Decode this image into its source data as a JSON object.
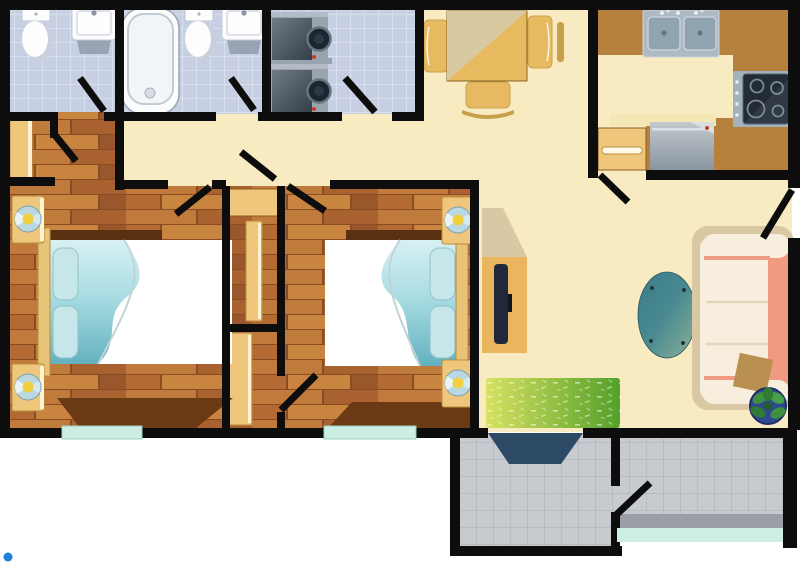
{
  "scene": {
    "type": "apartment-floor-plan",
    "style": "top-down illustrated floor plan, no text labels",
    "canvas": {
      "width": 800,
      "height": 564
    }
  },
  "colors": {
    "wall": "#0d0d0d",
    "cream": "#f8ebc2",
    "counter_dark": "#b5813d",
    "furniture_tan": "#eec77c",
    "window_teal": "#cdeee2",
    "bath_tile": "#c7cfe2",
    "gray_tile": "#c7cacf",
    "wood_base": "#b46b33",
    "bed_teal": "#8ccbd4",
    "pillow": "#c6e6ea",
    "sheet_white": "#ffffff",
    "sofa_cream": "#f7eedd",
    "sofa_salmon": "#f09a82",
    "shadow_beige": "#d9c8a3",
    "table_teal": "#4a8a90",
    "rug_green": "#5da232",
    "rug_green_light": "#d7e160",
    "plant_pot": "#2e4a8f",
    "plant_leaf": "#3e8f41",
    "mat_navy": "#2c4a66",
    "tv_dark": "#20293a",
    "lamp_blue": "#b9d8e2",
    "lamp_yellow": "#f2cf3d",
    "appliance_gray": "#9aa4ae",
    "appliance_dark": "#1d2530",
    "cursor_blue": "#1e80d6"
  },
  "rooms": [
    {
      "name": "bathroom-1",
      "floor": "blue-tile",
      "furniture": [
        "toilet",
        "pedestal-sink"
      ],
      "doors": 1
    },
    {
      "name": "bathroom-2",
      "floor": "blue-tile",
      "furniture": [
        "bathtub",
        "toilet",
        "pedestal-sink"
      ],
      "doors": 1
    },
    {
      "name": "laundry-room",
      "floor": "blue-tile",
      "furniture": [
        "stacked-washer",
        "stacked-dryer"
      ],
      "doors": 1
    },
    {
      "name": "dining-area",
      "floor": "cream",
      "furniture": [
        "square-dining-table",
        "chair-left",
        "chair-right",
        "chair-bottom"
      ]
    },
    {
      "name": "kitchen",
      "floor": "cream",
      "furniture": [
        "double-basin-sink",
        "l-shaped-counter",
        "cooktop",
        "dishwasher",
        "drawer-cabinet"
      ],
      "doors": 1
    },
    {
      "name": "hallway",
      "floor": "cream",
      "furniture": [
        "wardrobe"
      ]
    },
    {
      "name": "bedroom-1",
      "floor": "wood-plank",
      "furniture": [
        "double-bed",
        "headboard",
        "nightstand-lamp-top",
        "nightstand-lamp-bottom"
      ],
      "doors": 2,
      "windows": 1
    },
    {
      "name": "closet-column",
      "floor": "wood-plank",
      "furniture": [
        "shelf",
        "sliding-panel-top",
        "sliding-panel-bottom"
      ],
      "doors": 2
    },
    {
      "name": "bedroom-2",
      "floor": "wood-plank",
      "furniture": [
        "double-bed",
        "headboard",
        "nightstand-lamp-top",
        "nightstand-lamp-bottom"
      ],
      "doors": 1,
      "windows": 1
    },
    {
      "name": "living-room",
      "floor": "cream",
      "furniture": [
        "tv-console",
        "flat-tv",
        "oval-coffee-table",
        "three-seat-sofa",
        "throw-blanket",
        "potted-plant",
        "green-grass-rug"
      ],
      "doors": 1
    },
    {
      "name": "entry-vestibule",
      "floor": "gray-tile",
      "furniture": [
        "navy-doormat"
      ],
      "doors": 1
    },
    {
      "name": "balcony",
      "floor": "gray-tile",
      "furniture": [],
      "windows": 1
    }
  ],
  "openings": {
    "door_swings": 11,
    "windows": 3
  },
  "cursor": {
    "visible": true,
    "x": 8,
    "y": 557
  }
}
